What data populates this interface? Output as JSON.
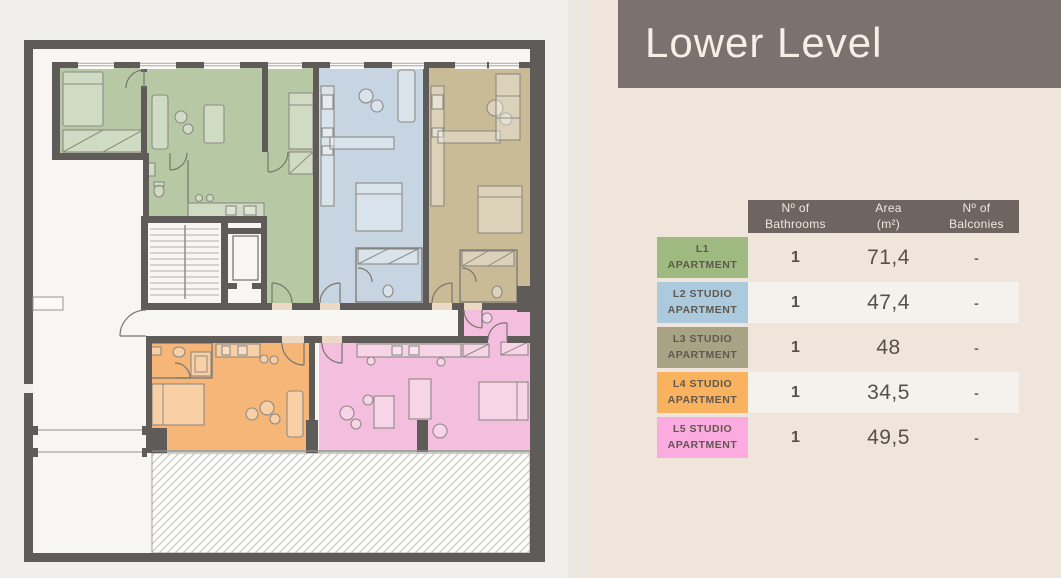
{
  "header": {
    "title": "Lower Level"
  },
  "table": {
    "columns": [
      {
        "line1": "Nº of",
        "line2": "Bathrooms"
      },
      {
        "line1": "Area",
        "line2": "(m²)"
      },
      {
        "line1": "Nº of",
        "line2": "Balconies"
      }
    ],
    "rows": [
      {
        "line1": "L1",
        "line2": "APARTMENT",
        "bathrooms": "1",
        "area": "71,4",
        "balconies": "-"
      },
      {
        "line1": "L2 STUDIO",
        "line2": "APARTMENT",
        "bathrooms": "1",
        "area": "47,4",
        "balconies": "-"
      },
      {
        "line1": "L3 STUDIO",
        "line2": "APARTMENT",
        "bathrooms": "1",
        "area": "48",
        "balconies": "-"
      },
      {
        "line1": "L4 STUDIO",
        "line2": "APARTMENT",
        "bathrooms": "1",
        "area": "34,5",
        "balconies": "-"
      },
      {
        "line1": "L5 STUDIO",
        "line2": "APARTMENT",
        "bathrooms": "1",
        "area": "49,5",
        "balconies": "-"
      }
    ]
  },
  "floor_plan": {
    "level": "Lower Level",
    "units": [
      {
        "id": "L1",
        "name": "L1 Apartment",
        "color_key": "l1_room"
      },
      {
        "id": "L2",
        "name": "L2 Studio Apartment",
        "color_key": "l2_room"
      },
      {
        "id": "L3",
        "name": "L3 Studio Apartment",
        "color_key": "l3_room"
      },
      {
        "id": "L4",
        "name": "L4 Studio Apartment",
        "color_key": "l4_room"
      },
      {
        "id": "L5",
        "name": "L5 Studio Apartment",
        "color_key": "l5_room"
      }
    ],
    "features": [
      "stairwell",
      "elevator-shaft",
      "central-corridor",
      "hatched-unexcavated-area"
    ]
  },
  "colors": {
    "page_left": "#f1efeb",
    "page_right": "#f0e5db",
    "strip": "#ece7e1",
    "header_bar": "#7b7270",
    "header_text": "#f7eee6",
    "table_header": "#6e6460",
    "table_header_text": "#f2e8e0",
    "row_alt": "#f5f2ee",
    "label_text": "#60584f",
    "value_text": "#565049",
    "dash_text": "#6b635c",
    "threshold": "#ecd9c5",
    "wall": "#5e5b58",
    "l1_label": "#9fba80",
    "l2_label": "#abcade",
    "l3_label": "#a8a385",
    "l4_label": "#f9b25e",
    "l5_label": "#fbabdf",
    "l1_room": "#b6c9a4",
    "l2_room": "#c6d5e1",
    "l3_room": "#cabb97",
    "l4_room": "#f6b678",
    "l5_room": "#f4bede"
  }
}
